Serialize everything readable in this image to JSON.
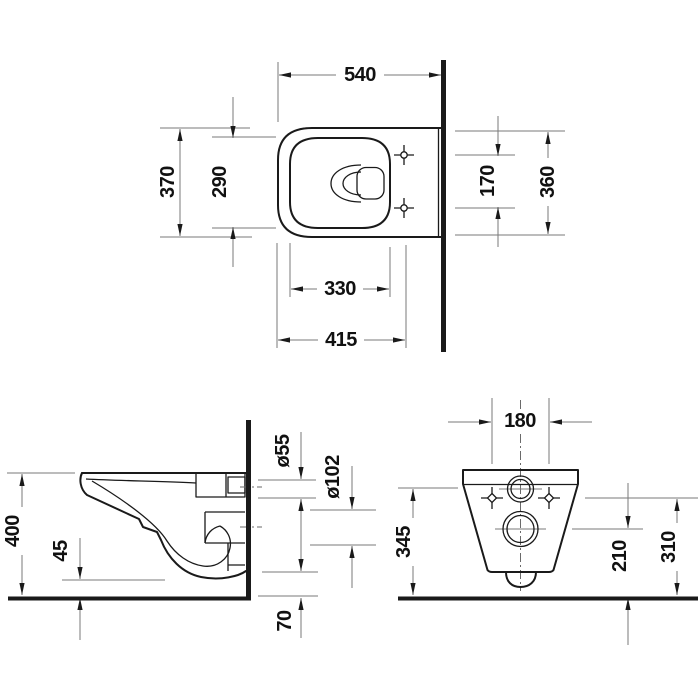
{
  "colors": {
    "object_line": "#1a1a1a",
    "dimension_line": "#7a7a7a",
    "text": "#111111",
    "wall_floor": "#000000",
    "background": "#ffffff"
  },
  "views": {
    "plan": {
      "dims": {
        "depth_total": "540",
        "width_total": "370",
        "bowl_width": "290",
        "fixing_hole_spacing": "170",
        "back_width": "360",
        "bowl_length": "330",
        "front_to_fixing_holes": "415"
      }
    },
    "side": {
      "dims": {
        "rim_height": "400",
        "bottom_clearance": "45",
        "flush_connection_dia": "ø55",
        "outlet_dia": "ø102",
        "outlet_bottom_height": "70"
      }
    },
    "front": {
      "dims": {
        "fixing_hole_spacing": "180",
        "flush_center_height": "345",
        "outlet_center_height": "210",
        "fixing_hole_height": "310"
      }
    }
  }
}
